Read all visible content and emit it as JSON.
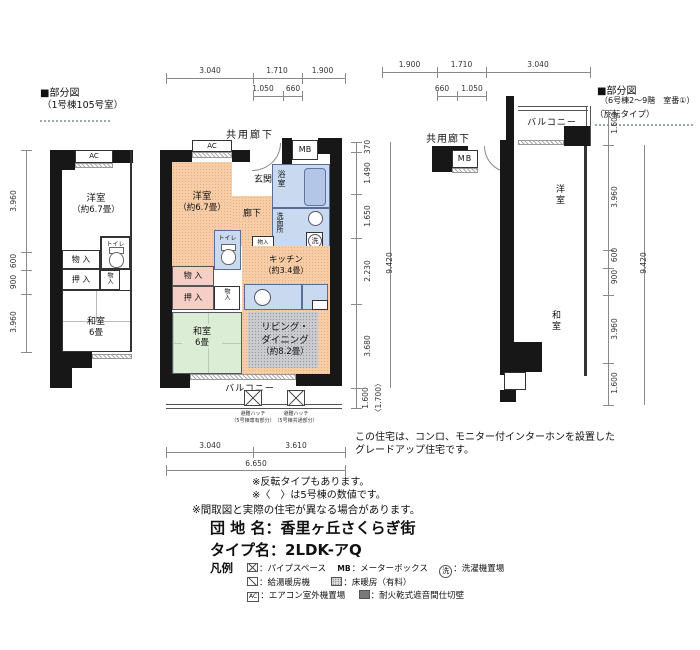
{
  "left_plan": {
    "header1": "■部分図",
    "header2": "（1号棟105号室）",
    "ac": "AC",
    "yoshitsu": "洋室",
    "yoshitsu_size": "（約6.7畳）",
    "toilet": "トイレ",
    "monoire": "物 入",
    "oshiire": "押 入",
    "monoire_small": "物入",
    "washitsu": "和室",
    "washitsu_size": "6畳",
    "dims": [
      "3.960",
      "600",
      "900",
      "3.960"
    ]
  },
  "center_plan": {
    "corridor": "共用廊下",
    "top_dims": [
      "3.040",
      "1.710",
      "1.900"
    ],
    "top_sub_dims": [
      "1.050",
      "660"
    ],
    "ac": "AC",
    "mb": "MB",
    "genkan": "玄関",
    "bath": "浴室",
    "yoshitsu": "洋室",
    "yoshitsu_size": "（約6.7畳）",
    "rouka": "廊下",
    "senmen": "洗面所",
    "wash_mark": "洗",
    "toilet": "トイレ",
    "mono_mini1": "物入",
    "monoire": "物 入",
    "oshiire": "押 入",
    "mono_mini2": "物入",
    "kitchen": "キッチン",
    "kitchen_size": "（約3.4畳）",
    "counter": "カウンター",
    "washitsu": "和室",
    "washitsu_size": "6畳",
    "living1": "リビング・",
    "living2": "ダイニング",
    "living_size": "（約8.2畳）",
    "balcony": "バルコニー",
    "hatch1_line1": "避難ハッチ",
    "hatch1_line2": "（5号棟専有部分）",
    "hatch2_line1": "避難ハッチ",
    "hatch2_line2": "（5号棟共通部分）",
    "right_dims": [
      "370",
      "1.490",
      "1.650",
      "2.230",
      "3.680"
    ],
    "right_total": "9.420",
    "balcony_dim": "1.600",
    "balcony_dim_alt": "〈1.700〉",
    "bottom_dims": [
      "3.040",
      "3.610"
    ],
    "bottom_total": "6.650"
  },
  "right_plan": {
    "header1": "■部分図",
    "header2": "（6号棟2～9階　室番①）",
    "header3": "（反転タイプ）",
    "corridor": "共用廊下",
    "mb": "MB",
    "balcony": "バルコニー",
    "yoshitsu": "洋室",
    "washitsu": "和室",
    "top_dims": [
      "1.900",
      "1.710",
      "3.040"
    ],
    "top_sub_dims": [
      "660",
      "1.050"
    ],
    "right_dims": [
      "1.600",
      "3.960",
      "600",
      "900",
      "3.960",
      "1.600"
    ],
    "right_total": "9.420"
  },
  "notes": {
    "upgrade1": "この住宅は、コンロ、モニター付インターホンを設置した",
    "upgrade2": "グレードアップ住宅です。",
    "reverse": "※反転タイプもあります。",
    "value5": "※〈　〉は5号棟の数値です。",
    "differ": "※間取図と実際の住宅が異なる場合があります。"
  },
  "info": {
    "danchi_label": "団 地 名",
    "danchi_value": "：香里ヶ丘さくらぎ街",
    "type_label": "タイプ名",
    "type_value": "：2LDK-アQ"
  },
  "legend": {
    "title": "凡例",
    "items": [
      {
        "sym": "",
        "label": "：パイプスペース"
      },
      {
        "sym": "MB",
        "label": "：メーターボックス"
      },
      {
        "sym": "洗",
        "label": "：洗濯機置場"
      },
      {
        "sym": "",
        "label": "：給湯暖房機"
      },
      {
        "sym": "",
        "label": "：床暖房（有料）"
      },
      {
        "sym": "AC",
        "label": "：エアコン室外機置場"
      },
      {
        "sym": "",
        "label": "：耐火乾式遮音間仕切壁"
      }
    ]
  }
}
